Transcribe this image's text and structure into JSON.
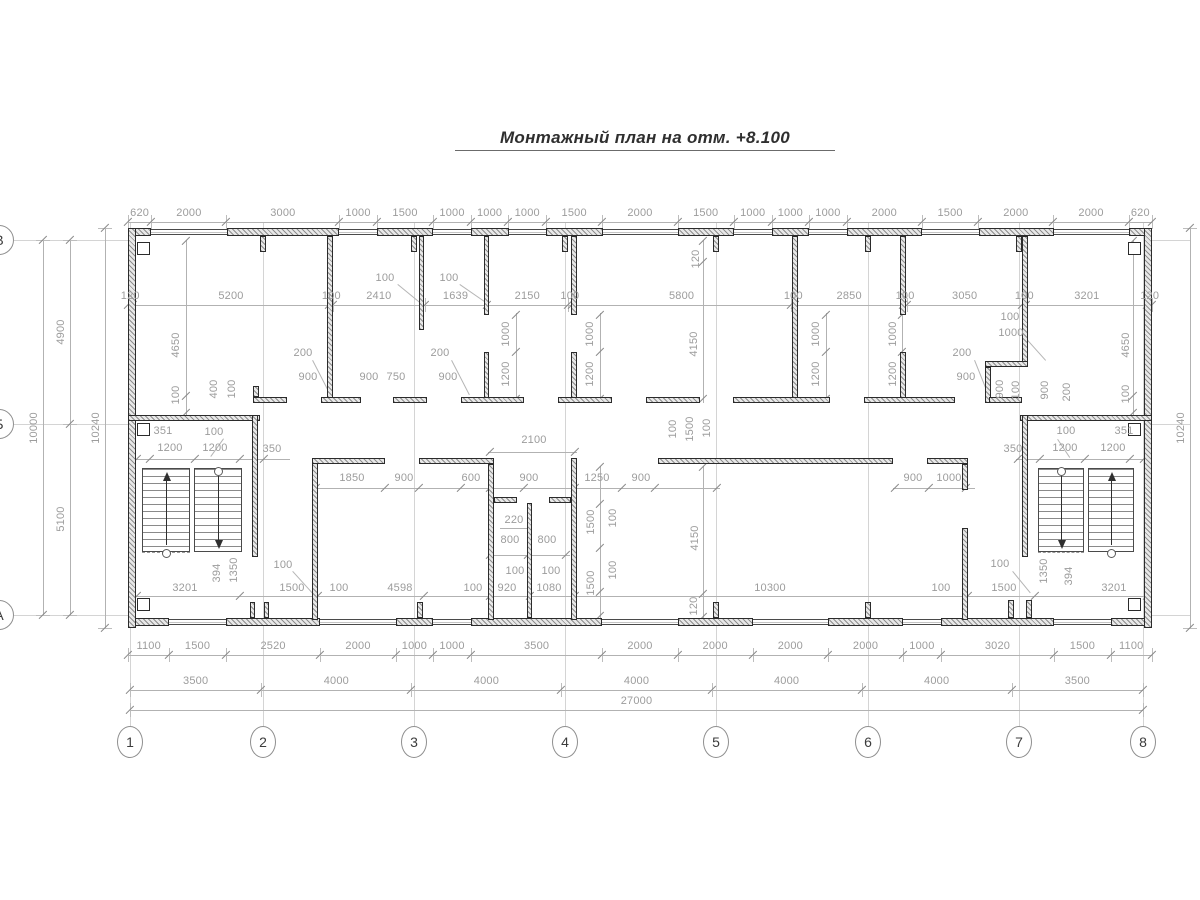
{
  "title": "Монтажный план на отм. +8.100",
  "drawing_type": "structural installation floor plan",
  "colors": {
    "wall_line": "#2b2b2b",
    "dimension_text": "#9c9c9c",
    "dimension_line": "#b2b2b2",
    "axis_line": "#d4d4d4",
    "title_text": "#2f2f2f"
  },
  "grid": {
    "column_bubbles": [
      [
        "1",
        130
      ],
      [
        "2",
        263
      ],
      [
        "3",
        414
      ],
      [
        "4",
        565
      ],
      [
        "5",
        716
      ],
      [
        "6",
        868
      ],
      [
        "7",
        1019
      ],
      [
        "8",
        1143
      ]
    ],
    "column_bubble_y": 742,
    "row_bubbles": [
      [
        "В",
        240
      ],
      [
        "Б",
        424
      ],
      [
        "А",
        615
      ]
    ],
    "row_bubble_x": 0
  },
  "chains": [
    {
      "o": "h",
      "x": 128,
      "y": 222,
      "s": 0.03759,
      "v": [
        620,
        2000,
        3000,
        1000,
        1500,
        1000,
        1000,
        1000,
        1500,
        2000,
        1500,
        1000,
        1000,
        1000,
        2000,
        1500,
        2000,
        2000,
        620
      ]
    },
    {
      "o": "h",
      "x": 128,
      "y": 305,
      "s": 0.03787,
      "v": [
        120,
        5200,
        100,
        2410,
        1639,
        2150,
        100,
        5800,
        100,
        2850,
        100,
        3050,
        100,
        3201,
        120
      ]
    },
    {
      "o": "h",
      "x": 128,
      "y": 655,
      "s": 0.03759,
      "v": [
        1100,
        1500,
        2520,
        2000,
        1000,
        1000,
        3500,
        2000,
        2000,
        2000,
        2000,
        1000,
        3020,
        1500,
        1100
      ]
    },
    {
      "o": "h",
      "x": 130,
      "y": 690,
      "s": 0.03752,
      "v": [
        3500,
        4000,
        4000,
        4000,
        4000,
        4000,
        3500
      ]
    },
    {
      "o": "h",
      "x": 130,
      "y": 710,
      "s": 0.03752,
      "v": [
        27000
      ]
    },
    {
      "o": "v",
      "x": 43,
      "y": 240,
      "s": 0.0375,
      "v": [
        10000
      ]
    },
    {
      "o": "v",
      "x": 70,
      "y": 240,
      "s": 0.0375,
      "v": [
        4900,
        5100
      ]
    },
    {
      "o": "v",
      "x": 105,
      "y": 228,
      "s": 0.03906,
      "v": [
        10240
      ]
    },
    {
      "o": "v",
      "x": 1190,
      "y": 228,
      "s": 0.03906,
      "v": [
        10240
      ]
    }
  ],
  "labels": [
    [
      "4650",
      176,
      345,
      -90
    ],
    [
      "100",
      176,
      395,
      -90
    ],
    [
      "400",
      214,
      389,
      -90
    ],
    [
      "100",
      232,
      389,
      -90
    ],
    [
      "200",
      303,
      353,
      0
    ],
    [
      "900",
      308,
      377,
      0
    ],
    [
      "900",
      369,
      377,
      0
    ],
    [
      "750",
      396,
      377,
      0
    ],
    [
      "200",
      440,
      353,
      0
    ],
    [
      "900",
      448,
      377,
      0
    ],
    [
      "1000",
      506,
      334,
      -90
    ],
    [
      "1200",
      506,
      374,
      -90
    ],
    [
      "1000",
      590,
      334,
      -90
    ],
    [
      "1200",
      590,
      374,
      -90
    ],
    [
      "120",
      696,
      259,
      -90
    ],
    [
      "4150",
      694,
      344,
      -90
    ],
    [
      "1000",
      816,
      334,
      -90
    ],
    [
      "1200",
      816,
      374,
      -90
    ],
    [
      "1000",
      893,
      334,
      -90
    ],
    [
      "1200",
      893,
      374,
      -90
    ],
    [
      "200",
      962,
      353,
      0
    ],
    [
      "900",
      966,
      377,
      0
    ],
    [
      "100",
      1010,
      317,
      0
    ],
    [
      "1000",
      1011,
      333,
      0
    ],
    [
      "900",
      1000,
      389,
      -90
    ],
    [
      "100",
      1016,
      390,
      -90
    ],
    [
      "900",
      1045,
      390,
      -90
    ],
    [
      "200",
      1067,
      392,
      -90
    ],
    [
      "4650",
      1126,
      345,
      -90
    ],
    [
      "100",
      1126,
      394,
      -90
    ],
    [
      "100",
      385,
      278,
      0
    ],
    [
      "100",
      449,
      278,
      0
    ],
    [
      "351",
      163,
      431,
      0
    ],
    [
      "100",
      214,
      432,
      0
    ],
    [
      "1200",
      170,
      448,
      0
    ],
    [
      "1200",
      215,
      448,
      0
    ],
    [
      "350",
      272,
      449,
      0
    ],
    [
      "2100",
      534,
      440,
      0
    ],
    [
      "1850",
      352,
      478,
      0
    ],
    [
      "900",
      404,
      478,
      0
    ],
    [
      "600",
      471,
      478,
      0
    ],
    [
      "900",
      529,
      478,
      0
    ],
    [
      "1250",
      597,
      478,
      0
    ],
    [
      "900",
      641,
      478,
      0
    ],
    [
      "900",
      913,
      478,
      0
    ],
    [
      "1000",
      949,
      478,
      0
    ],
    [
      "350",
      1013,
      449,
      0
    ],
    [
      "1200",
      1065,
      448,
      0
    ],
    [
      "1200",
      1113,
      448,
      0
    ],
    [
      "100",
      1066,
      431,
      0
    ],
    [
      "351",
      1124,
      431,
      0
    ],
    [
      "100",
      673,
      429,
      -90
    ],
    [
      "1500",
      690,
      429,
      -90
    ],
    [
      "100",
      707,
      428,
      -90
    ],
    [
      "1500",
      591,
      522,
      -90
    ],
    [
      "100",
      613,
      518,
      -90
    ],
    [
      "1500",
      591,
      583,
      -90
    ],
    [
      "100",
      613,
      570,
      -90
    ],
    [
      "4150",
      695,
      538,
      -90
    ],
    [
      "120",
      694,
      606,
      -90
    ],
    [
      "220",
      514,
      520,
      0
    ],
    [
      "800",
      510,
      540,
      0
    ],
    [
      "800",
      547,
      540,
      0
    ],
    [
      "100",
      515,
      571,
      0
    ],
    [
      "100",
      551,
      571,
      0
    ],
    [
      "3201",
      185,
      588,
      0
    ],
    [
      "394",
      217,
      573,
      -90
    ],
    [
      "1350",
      234,
      570,
      -90
    ],
    [
      "100",
      283,
      565,
      0
    ],
    [
      "1500",
      292,
      588,
      0
    ],
    [
      "100",
      339,
      588,
      0
    ],
    [
      "4598",
      400,
      588,
      0
    ],
    [
      "100",
      473,
      588,
      0
    ],
    [
      "920",
      507,
      588,
      0
    ],
    [
      "1080",
      549,
      588,
      0
    ],
    [
      "10300",
      770,
      588,
      0
    ],
    [
      "100",
      941,
      588,
      0
    ],
    [
      "100",
      1000,
      564,
      0
    ],
    [
      "1500",
      1004,
      588,
      0
    ],
    [
      "1350",
      1044,
      571,
      -90
    ],
    [
      "394",
      1069,
      576,
      -90
    ],
    [
      "3201",
      1114,
      588,
      0
    ]
  ],
  "walls": [
    [
      128,
      228,
      23,
      8
    ],
    [
      227,
      228,
      112,
      8
    ],
    [
      377,
      228,
      56,
      8
    ],
    [
      471,
      228,
      38,
      8
    ],
    [
      546,
      228,
      57,
      8
    ],
    [
      678,
      228,
      56,
      8
    ],
    [
      772,
      228,
      37,
      8
    ],
    [
      847,
      228,
      75,
      8
    ],
    [
      979,
      228,
      75,
      8
    ],
    [
      1129,
      228,
      23,
      8
    ],
    [
      128,
      618,
      41,
      8
    ],
    [
      226,
      618,
      94,
      8
    ],
    [
      396,
      618,
      37,
      8
    ],
    [
      471,
      618,
      131,
      8
    ],
    [
      678,
      618,
      75,
      8
    ],
    [
      828,
      618,
      75,
      8
    ],
    [
      941,
      618,
      113,
      8
    ],
    [
      1111,
      618,
      41,
      8
    ],
    [
      128,
      228,
      8,
      400
    ],
    [
      1144,
      228,
      8,
      400
    ],
    [
      327,
      236,
      6,
      167
    ],
    [
      419,
      236,
      5,
      94
    ],
    [
      484,
      236,
      5,
      79
    ],
    [
      484,
      352,
      5,
      51
    ],
    [
      571,
      236,
      6,
      79
    ],
    [
      571,
      352,
      6,
      51
    ],
    [
      792,
      236,
      6,
      167
    ],
    [
      900,
      236,
      6,
      79
    ],
    [
      900,
      352,
      6,
      51
    ],
    [
      1022,
      236,
      6,
      129
    ],
    [
      985,
      361,
      43,
      6
    ],
    [
      985,
      367,
      6,
      36
    ],
    [
      253,
      386,
      6,
      11
    ],
    [
      253,
      397,
      34,
      6
    ],
    [
      321,
      397,
      40,
      6
    ],
    [
      393,
      397,
      34,
      6
    ],
    [
      461,
      397,
      63,
      6
    ],
    [
      558,
      397,
      54,
      6
    ],
    [
      646,
      397,
      54,
      6
    ],
    [
      733,
      397,
      97,
      6
    ],
    [
      864,
      397,
      91,
      6
    ],
    [
      989,
      397,
      33,
      6
    ],
    [
      128,
      415,
      132,
      6
    ],
    [
      1020,
      415,
      132,
      6
    ],
    [
      252,
      415,
      6,
      142
    ],
    [
      1022,
      415,
      6,
      142
    ],
    [
      312,
      458,
      6,
      162
    ],
    [
      312,
      458,
      73,
      6
    ],
    [
      419,
      458,
      75,
      6
    ],
    [
      488,
      464,
      6,
      156
    ],
    [
      494,
      497,
      23,
      6
    ],
    [
      549,
      497,
      22,
      6
    ],
    [
      527,
      503,
      5,
      115
    ],
    [
      571,
      458,
      6,
      162
    ],
    [
      658,
      458,
      235,
      6
    ],
    [
      927,
      458,
      41,
      6
    ],
    [
      962,
      464,
      6,
      26
    ],
    [
      962,
      528,
      6,
      92
    ],
    [
      1008,
      600,
      6,
      18
    ],
    [
      1026,
      600,
      6,
      18
    ],
    [
      250,
      602,
      5,
      16
    ],
    [
      264,
      602,
      5,
      16
    ],
    [
      260,
      236,
      6,
      16
    ],
    [
      411,
      236,
      6,
      16
    ],
    [
      562,
      236,
      6,
      16
    ],
    [
      713,
      236,
      6,
      16
    ],
    [
      865,
      236,
      6,
      16
    ],
    [
      1016,
      236,
      6,
      16
    ],
    [
      417,
      602,
      6,
      16
    ],
    [
      713,
      602,
      6,
      16
    ],
    [
      865,
      602,
      6,
      16
    ]
  ],
  "notches": [
    [
      137,
      242
    ],
    [
      137,
      423
    ],
    [
      137,
      598
    ],
    [
      1128,
      242
    ],
    [
      1128,
      423
    ],
    [
      1128,
      598
    ]
  ],
  "windows_top": [
    [
      151,
      76
    ],
    [
      339,
      38
    ],
    [
      433,
      38
    ],
    [
      509,
      37
    ],
    [
      603,
      75
    ],
    [
      734,
      38
    ],
    [
      809,
      38
    ],
    [
      922,
      57
    ],
    [
      1054,
      75
    ]
  ],
  "windows_bottom": [
    [
      169,
      57
    ],
    [
      320,
      76
    ],
    [
      433,
      38
    ],
    [
      602,
      76
    ],
    [
      753,
      75
    ],
    [
      903,
      38
    ],
    [
      1054,
      57
    ]
  ],
  "window_y": {
    "top": 229,
    "bottom": 619
  },
  "dimlines": [
    [
      136,
      459,
      154,
      1,
      [
        137,
        150,
        195,
        240,
        264
      ]
    ],
    [
      1016,
      459,
      132,
      1,
      [
        1018,
        1040,
        1085,
        1130,
        1144
      ]
    ],
    [
      313,
      488,
      407,
      1,
      [
        316,
        385,
        419,
        461,
        490,
        524,
        575,
        622,
        655,
        717
      ]
    ],
    [
      893,
      488,
      82,
      1,
      [
        895,
        929,
        966
      ]
    ],
    [
      488,
      452,
      89,
      1,
      [
        490,
        575
      ]
    ],
    [
      136,
      596,
      1012,
      1,
      [
        137,
        240,
        318,
        424,
        490,
        530,
        575,
        968,
        1035,
        1147
      ]
    ],
    [
      488,
      555,
      82,
      1,
      [
        490,
        528,
        566
      ]
    ],
    [
      500,
      528,
      28,
      1,
      []
    ],
    [
      600,
      466,
      1,
      152,
      [
        467,
        504,
        548,
        592,
        616
      ]
    ],
    [
      703,
      466,
      1,
      152,
      [
        467,
        594,
        617
      ]
    ],
    [
      703,
      240,
      1,
      163,
      [
        241,
        262,
        399
      ]
    ],
    [
      186,
      240,
      1,
      176,
      [
        241,
        396,
        413
      ]
    ],
    [
      1133,
      240,
      1,
      176,
      [
        241,
        396,
        413
      ]
    ],
    [
      516,
      313,
      1,
      90,
      [
        315,
        352,
        399
      ]
    ],
    [
      600,
      313,
      1,
      90,
      [
        315,
        352,
        399
      ]
    ],
    [
      826,
      313,
      1,
      90,
      [
        315,
        352,
        399
      ]
    ],
    [
      902,
      313,
      1,
      90,
      [
        315,
        352,
        399
      ]
    ]
  ],
  "dashlines": [
    [
      142,
      552,
      48
    ],
    [
      194,
      470,
      48
    ],
    [
      1038,
      552,
      46
    ],
    [
      1088,
      470,
      46
    ]
  ],
  "leaders": [
    [
      398,
      284,
      420,
      302
    ],
    [
      460,
      284,
      486,
      302
    ],
    [
      224,
      439,
      211,
      457
    ],
    [
      1058,
      439,
      1070,
      457
    ],
    [
      313,
      360,
      331,
      395
    ],
    [
      452,
      360,
      470,
      395
    ],
    [
      293,
      571,
      313,
      593
    ],
    [
      1013,
      571,
      1031,
      593
    ],
    [
      975,
      360,
      989,
      395
    ],
    [
      1028,
      340,
      1046,
      360
    ]
  ],
  "stairs": {
    "flights": [
      [
        142,
        468,
        48,
        84
      ],
      [
        194,
        468,
        48,
        84
      ],
      [
        1038,
        468,
        46,
        84
      ],
      [
        1088,
        468,
        46,
        84
      ]
    ],
    "arrows": [
      {
        "x": 166,
        "dir": "up"
      },
      {
        "x": 218,
        "dir": "down"
      },
      {
        "x": 1061,
        "dir": "down"
      },
      {
        "x": 1111,
        "dir": "up"
      }
    ],
    "arrow_y1": 472,
    "arrow_y2": 549,
    "start_circles": [
      [
        166,
        553
      ],
      [
        218,
        471
      ],
      [
        1061,
        471
      ],
      [
        1111,
        553
      ]
    ]
  },
  "axis_extent": {
    "col_y1": 222,
    "col_y2": 726,
    "row_x1": 14,
    "row_x2": 128,
    "row_x3": 1152,
    "row_x4": 1190
  }
}
